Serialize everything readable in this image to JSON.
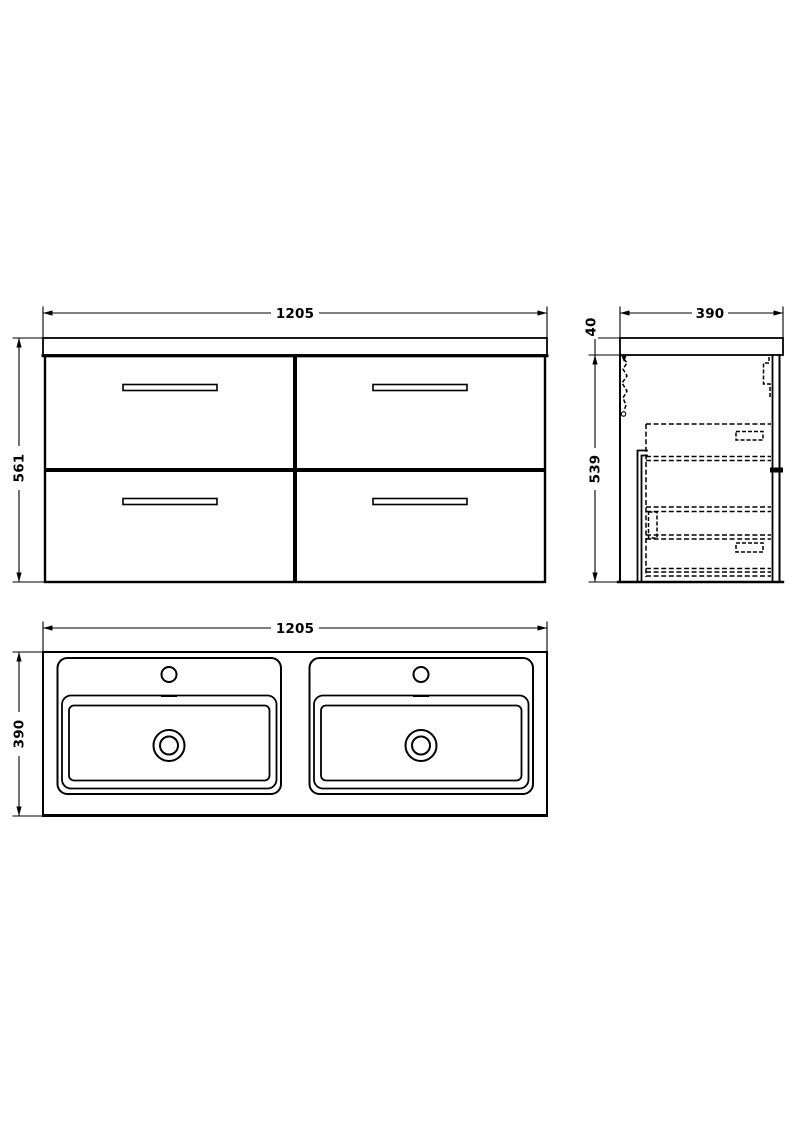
{
  "drawing": {
    "front_view": {
      "width_label": "1205",
      "height_label": "561"
    },
    "side_view": {
      "depth_label": "390",
      "worktop_thickness_label": "40",
      "cabinet_height_label": "539"
    },
    "plan_view": {
      "width_label": "1205",
      "depth_label": "390"
    }
  },
  "colors": {
    "line": "#000000",
    "background": "#ffffff"
  }
}
